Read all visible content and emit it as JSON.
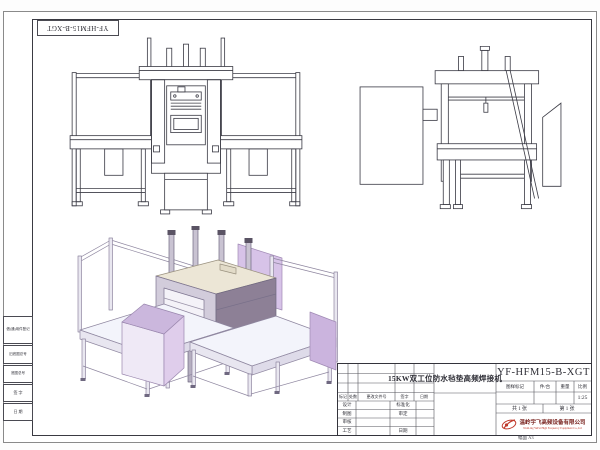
{
  "sheet": {
    "corner_label": "YF-HFM15-B-XGT",
    "size_label": "幅面 A3"
  },
  "left_strip": {
    "items": [
      "借(通)用件登记",
      "旧底图总号",
      "底图总号",
      "签  字",
      "日  期"
    ]
  },
  "title_block": {
    "drawing_no": "YF-HFM15-B-XGT",
    "product_title": "15KW双工位防水毡垫高频焊接机",
    "rev_header": [
      "标记",
      "处数",
      "更改文件号",
      "签字",
      "日期"
    ],
    "roles_left": [
      "设计",
      "制图",
      "审核",
      "工艺"
    ],
    "roles_right": [
      "标准化",
      "审定",
      "",
      "日期"
    ],
    "mark_header": [
      "图样标记",
      "件/台",
      "重量",
      "比例"
    ],
    "scale": "1:25",
    "sheet_total": "共 1 张",
    "sheet_index": "第 1 张",
    "company_cn": "温岭宇飞高频设备有限公司",
    "company_en": "WenLing YuFei High Frequency Equipment Co.,Ltd",
    "colors": {
      "accent_red": "#c0392b",
      "company_red": "#7a2420",
      "line_dark": "#3a3a42"
    }
  }
}
